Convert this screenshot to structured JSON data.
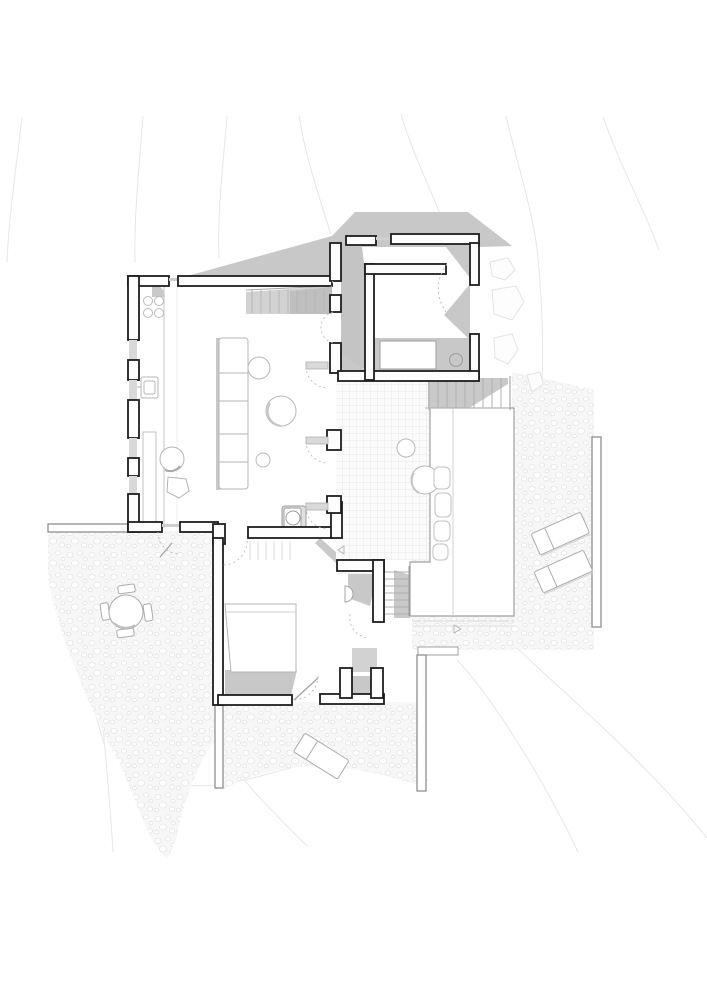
{
  "plan": {
    "title": "Hillside house ground floor plan",
    "description": "Black-line architectural floor plan with cast shadows, tiled courtyard, timber deck, pebble terraces and topographic contour lines",
    "colors": {
      "background": "#ffffff",
      "wall_line": "#1d1d1d",
      "shadow": "#c7c7c7",
      "furniture_line": "#b0b0b0",
      "retaining_wall_line": "#8f8f8f",
      "tile_grid_line": "#e2e2e2",
      "pebble_line": "#e4e4e4",
      "contour_line": "#e6e6e6"
    },
    "rooms": [
      {
        "id": "living-kitchen",
        "label": "Open living and kitchen room"
      },
      {
        "id": "guest-room",
        "label": "Upper guest room with covered porch"
      },
      {
        "id": "courtyard",
        "label": "Tiled courtyard"
      },
      {
        "id": "bedroom",
        "label": "Lower bedroom"
      },
      {
        "id": "wc",
        "label": "WC niche"
      },
      {
        "id": "deck",
        "label": "Timber deck"
      },
      {
        "id": "gravel-terrace",
        "label": "Pebble terrace"
      }
    ],
    "furniture": [
      "kitchen counter with four-ring cooktop and sink",
      "long sideboard / sofa unit",
      "three round coffee tables",
      "two armchairs",
      "double bed",
      "bed in guest room with side table",
      "WC pan",
      "small wall basin",
      "round outdoor table with four chairs",
      "bench cushions beside courtyard",
      "two sun loungers by the deck",
      "one sun lounger on lower terrace",
      "two planter trees in courtyard"
    ],
    "circulation": [
      "top entry steps",
      "exterior stair down to deck",
      "internal stair to lower level",
      "shallow ramp steps to bedroom corridor"
    ],
    "site_elements": [
      "topographic contour lines",
      "stone slabs east of guest room",
      "pebble paving areas",
      "thin retaining walls",
      "dashed door swing arcs"
    ]
  }
}
